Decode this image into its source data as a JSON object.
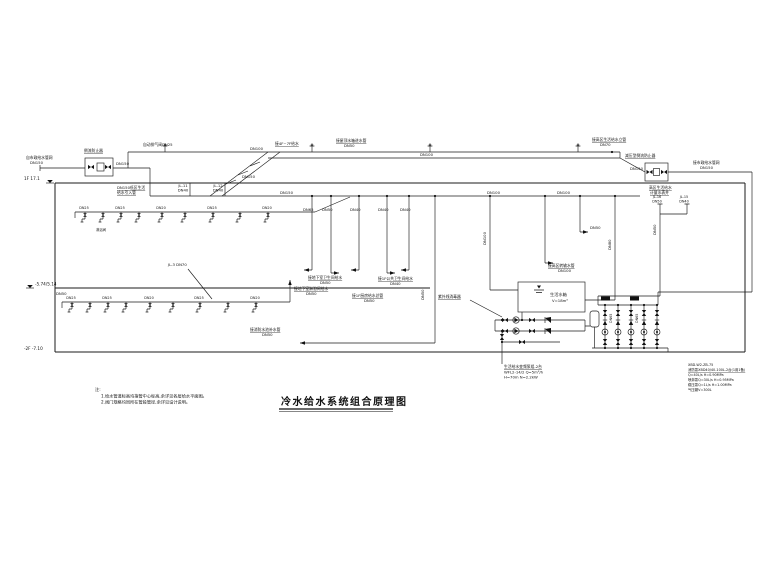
{
  "title": {
    "text": "冷水给水系统组合原理图"
  },
  "levels": {
    "l1": "1F 17.1",
    "l2": "-5.74/5.14",
    "l3": "-2F -7.10"
  },
  "inlet_low": {
    "source1": "自市政给水管网",
    "source2": "DN150",
    "device": "倒流防止器",
    "dn": "DN150",
    "below1": "DN150低区生活",
    "below2": "给水引入管"
  },
  "top": {
    "vent": "自动排气阀DN25",
    "tag1a": "JL-11",
    "tag1b": "DN40",
    "tag2a": "JL-12",
    "tag2b": "DN40",
    "dn100a": "DN100",
    "mid": "接4F~7F给水",
    "roof1": "接屋顶水箱进水管",
    "roof2": "DN50",
    "dn100b": "DN100",
    "high1": "接高区生活给水立管",
    "high2": "DN70",
    "ramp_dn": "DN150"
  },
  "header": {
    "dn150": "DN150",
    "dn100": "DN100",
    "dn100r": "DN100"
  },
  "inlet_high": {
    "device": "减压型倒流防止器",
    "dn": "DN150",
    "right1": "接市政给水管网",
    "right2": "DN150",
    "below1": "高区生活给水",
    "below2": "计量水表井"
  },
  "risers": {
    "d1": "DN65",
    "d2": "DN50",
    "d3": "DN40",
    "d4": "DN40",
    "d5": "DN40",
    "pool_dn": "DN50",
    "dn100v": "DN100",
    "dn80v": "DN80",
    "dn50v": "DN50",
    "branch_dn": "DN50",
    "jl16a": "JL-16",
    "jl16b": "DN50",
    "jl15a": "JL-15",
    "jl15b": "DN40"
  },
  "conn": {
    "c1a": "接地下室卫生间给水",
    "c1b": "DN50",
    "c2a": "接1F厨房给水总管",
    "c2b": "DN50",
    "c3a": "接1F公共卫生间给水",
    "c3b": "DN40",
    "c4a": "接地下室淋浴间给水",
    "c4b": "DN50",
    "c6a": "接消防水池补水管",
    "c6b": "DN50",
    "c7a": "接高区转输水管",
    "c7b": "DN100"
  },
  "row1": {
    "dn1": "DN25",
    "dn2": "DN25",
    "dn3": "DN20",
    "dn4": "DN25",
    "dn5": "DN20",
    "sub": "淋浴间"
  },
  "row2": {
    "dn1": "DN25",
    "dn2": "DN25",
    "dn3": "DN20",
    "dn4": "DN25",
    "dn5": "DN20",
    "left_dn": "DN50",
    "tag": "JL-3 DN70"
  },
  "tank": {
    "name": "生活水箱",
    "vol": "V=18m³"
  },
  "pump_low": {
    "uv": "紫外线消毒器",
    "s1": "生活给水变频泵组-2台",
    "s2": "WFL2-14/2 Q=5m³/h",
    "s3": "H=70m N=2.2kW"
  },
  "fire": {
    "r1": "XBD-W2-ZB-75",
    "r2": "消防泵XBD40/40-100L-2台(1用1备)",
    "r3": "Q=40L/s H=0.90MPa",
    "r4": "喷淋泵Q=30L/s H=0.95MPa",
    "r5": "稳压泵Q=1L/s H=1.00MPa",
    "r6": "气压罐V=300L",
    "dn1": "DN65",
    "dn2": "DN65"
  },
  "notes": {
    "h": "注:",
    "n1": "1.给水管道标高均指管中心标高,余详见各层给水平面图。",
    "n2": "2.阀门规格均同所在管段管径,余详见设计说明。"
  }
}
